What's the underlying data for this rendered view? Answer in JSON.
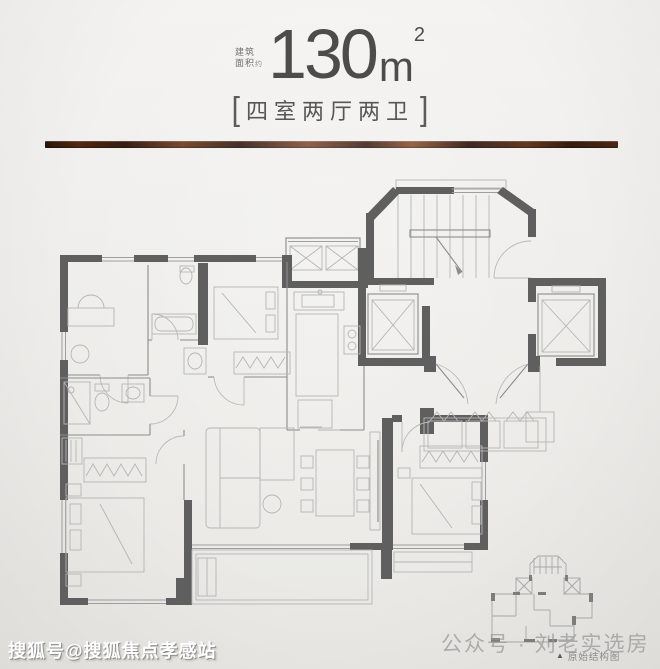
{
  "header": {
    "area_label_line1": "建筑",
    "area_label_line2": "面积",
    "area_label_suffix": "约",
    "area_value": "130",
    "area_unit_base": "m",
    "area_unit_exponent": "2",
    "bracket_left": "[",
    "bracket_right": "]",
    "layout_tag": "四室两厅两卫"
  },
  "divider": {
    "style": "copper-grain-bar",
    "colors": [
      "#2a140c",
      "#6e3c1e",
      "#8a4e2e",
      "#351a0f"
    ]
  },
  "floorplan": {
    "wall_color": "#5f5f5f",
    "partition_color": "#8c8c8c",
    "furniture_color": "#b5b5b5",
    "features": [
      "stairwell",
      "elevator",
      "elevator",
      "equipment-platform",
      "kitchen",
      "bathroom",
      "bathroom",
      "bedroom",
      "bedroom",
      "bedroom",
      "bedroom",
      "living-dining",
      "balcony",
      "entry-porch"
    ]
  },
  "mini_plan": {
    "triangle_icon": "▲",
    "caption": "原始结构图"
  },
  "watermarks": {
    "bottom_left": "搜狐号@搜狐焦点孝感站",
    "bottom_right": "公众号 · 刘老实选房"
  }
}
